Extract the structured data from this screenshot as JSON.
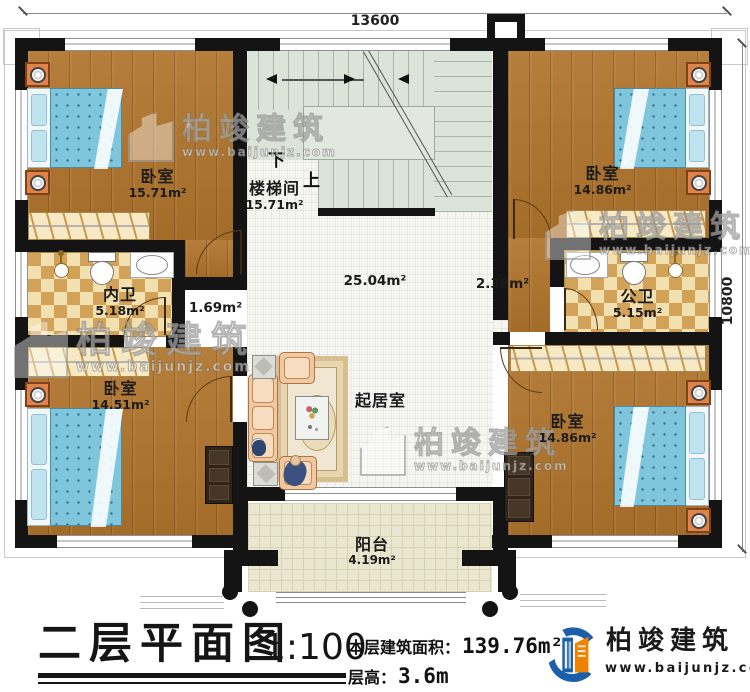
{
  "dimensions": {
    "top": "13600",
    "right": "10800"
  },
  "rooms": {
    "bedroom_tl": {
      "name": "卧室",
      "area": "15.71m²"
    },
    "stairwell": {
      "name": "楼梯间",
      "area": "15.71m²",
      "down": "下",
      "up": "上"
    },
    "bedroom_tr": {
      "name": "卧室",
      "area": "14.86m²"
    },
    "bath_inner": {
      "name": "内卫",
      "area": "5.18m²"
    },
    "hall_small": {
      "area": "1.69m²"
    },
    "hall_main": {
      "area": "25.04m²"
    },
    "hall_right": {
      "area": "2.38m²"
    },
    "bath_public": {
      "name": "公卫",
      "area": "5.15m²"
    },
    "bedroom_bl": {
      "name": "卧室",
      "area": "14.51m²"
    },
    "living": {
      "name": "起居室"
    },
    "bedroom_br": {
      "name": "卧室",
      "area": "14.86m²"
    },
    "balcony": {
      "name": "阳台",
      "area": "4.19m²"
    }
  },
  "footer": {
    "title": "二层平面图",
    "scale": "1:100",
    "area_label": "本层建筑面积：",
    "area_value": "139.76m²",
    "floor_height_label": "层高：",
    "floor_height_value": "3.6m"
  },
  "brand": {
    "name": "柏竣建筑",
    "url": "www.baijunjz.com"
  },
  "watermark": {
    "name": "柏竣建筑",
    "url": "www.baijunjz.com"
  }
}
